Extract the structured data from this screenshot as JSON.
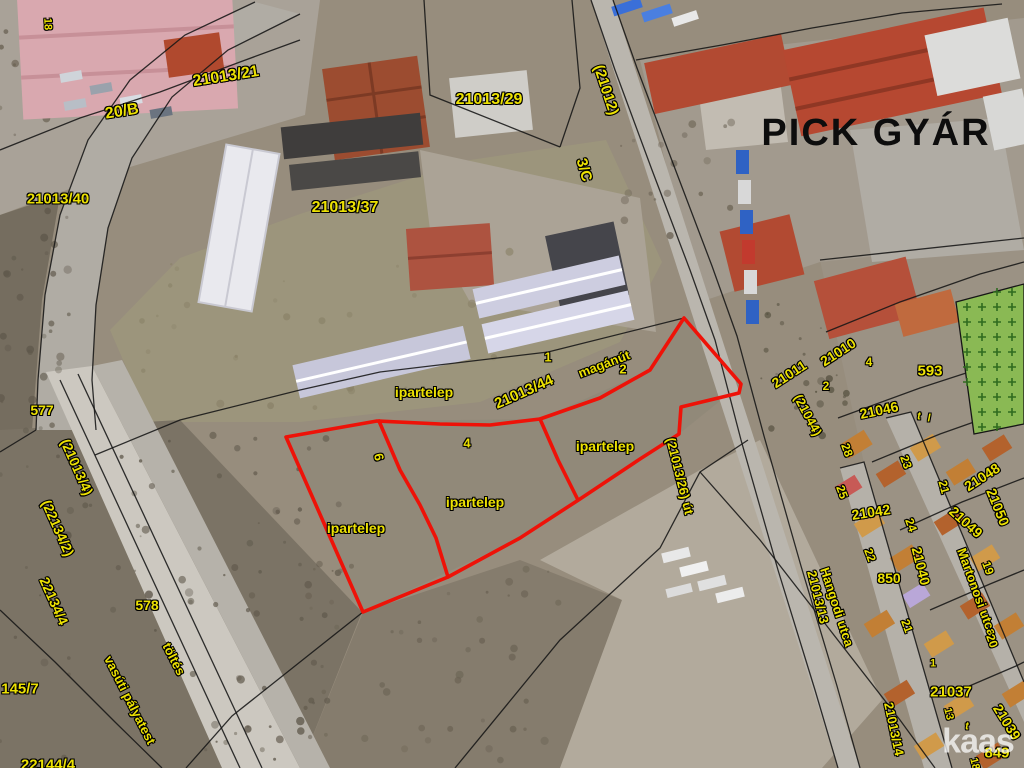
{
  "map": {
    "factory_name": "PICK GYÁR",
    "watermark": {
      "t": "kaas",
      "x": 978,
      "y": 742
    },
    "colors": {
      "label_yellow": "#ece103",
      "red_outline": "#ee1208",
      "boundary_black": "#161616",
      "green_field": "#8ab954",
      "green_cross": "#2f6b1f"
    },
    "labels": [
      {
        "t": "18",
        "x": 47,
        "y": 24,
        "r": 88,
        "s": 11
      },
      {
        "t": "21013/21",
        "x": 226,
        "y": 77,
        "r": -9,
        "s": 16
      },
      {
        "t": "20/B",
        "x": 122,
        "y": 112,
        "r": -9,
        "s": 16
      },
      {
        "t": "21013/40",
        "x": 58,
        "y": 199,
        "r": 0,
        "s": 15
      },
      {
        "t": "21013/29",
        "x": 489,
        "y": 100,
        "r": 0,
        "s": 16
      },
      {
        "t": "(21012)",
        "x": 606,
        "y": 90,
        "r": 72,
        "s": 15
      },
      {
        "t": "3/C",
        "x": 584,
        "y": 170,
        "r": 74,
        "s": 15
      },
      {
        "t": "21013/37",
        "x": 345,
        "y": 208,
        "r": 0,
        "s": 16
      },
      {
        "t": "PICK GYÁR",
        "x": 876,
        "y": 133,
        "r": 0,
        "s": 38,
        "c": "k"
      },
      {
        "t": "577",
        "x": 42,
        "y": 410,
        "r": 0,
        "s": 14
      },
      {
        "t": "(21013/4)",
        "x": 77,
        "y": 467,
        "r": 66,
        "s": 14
      },
      {
        "t": "(22134/2)",
        "x": 58,
        "y": 528,
        "r": 66,
        "s": 14
      },
      {
        "t": "22134/4",
        "x": 54,
        "y": 601,
        "r": 66,
        "s": 14
      },
      {
        "t": "578",
        "x": 147,
        "y": 605,
        "r": 0,
        "s": 14
      },
      {
        "t": "töltés",
        "x": 174,
        "y": 659,
        "r": 63,
        "s": 13
      },
      {
        "t": "vasúti pályatest",
        "x": 130,
        "y": 700,
        "r": 63,
        "s": 13
      },
      {
        "t": "145/7",
        "x": 20,
        "y": 689,
        "r": 0,
        "s": 15
      },
      {
        "t": "22144/4",
        "x": 48,
        "y": 765,
        "r": 0,
        "s": 15
      },
      {
        "t": "ipartelep",
        "x": 424,
        "y": 392,
        "r": 0,
        "s": 14
      },
      {
        "t": "1",
        "x": 548,
        "y": 357,
        "r": 0,
        "s": 13
      },
      {
        "t": "21013/44",
        "x": 524,
        "y": 392,
        "r": -24,
        "s": 15
      },
      {
        "t": "magánút",
        "x": 604,
        "y": 364,
        "r": -21,
        "s": 13
      },
      {
        "t": "2",
        "x": 623,
        "y": 369,
        "r": 0,
        "s": 13
      },
      {
        "t": "4",
        "x": 467,
        "y": 443,
        "r": 0,
        "s": 13
      },
      {
        "t": "6",
        "x": 379,
        "y": 457,
        "r": 78,
        "s": 13
      },
      {
        "t": "ipartelep",
        "x": 605,
        "y": 446,
        "r": 0,
        "s": 14
      },
      {
        "t": "ipartelep",
        "x": 475,
        "y": 502,
        "r": 0,
        "s": 14
      },
      {
        "t": "ipartelep",
        "x": 356,
        "y": 528,
        "r": 0,
        "s": 14
      },
      {
        "t": "(21013/26) út",
        "x": 680,
        "y": 476,
        "r": 76,
        "s": 13
      },
      {
        "t": "21011",
        "x": 789,
        "y": 374,
        "r": -33,
        "s": 14
      },
      {
        "t": "21010",
        "x": 838,
        "y": 352,
        "r": -33,
        "s": 14
      },
      {
        "t": "4",
        "x": 869,
        "y": 362,
        "r": 0,
        "s": 12
      },
      {
        "t": "2",
        "x": 826,
        "y": 386,
        "r": 0,
        "s": 12
      },
      {
        "t": "593",
        "x": 930,
        "y": 371,
        "r": 0,
        "s": 15
      },
      {
        "t": "(21044)",
        "x": 808,
        "y": 415,
        "r": 62,
        "s": 13
      },
      {
        "t": "21046",
        "x": 879,
        "y": 410,
        "r": -12,
        "s": 14
      },
      {
        "t": "t",
        "x": 919,
        "y": 417,
        "r": 0,
        "s": 11,
        "c": "i"
      },
      {
        "t": "l",
        "x": 929,
        "y": 419,
        "r": 0,
        "s": 11,
        "c": "i"
      },
      {
        "t": "28",
        "x": 847,
        "y": 450,
        "r": 70,
        "s": 12
      },
      {
        "t": "23",
        "x": 906,
        "y": 462,
        "r": 70,
        "s": 12
      },
      {
        "t": "21",
        "x": 944,
        "y": 487,
        "r": 75,
        "s": 12
      },
      {
        "t": "21048",
        "x": 982,
        "y": 477,
        "r": -33,
        "s": 14
      },
      {
        "t": "25",
        "x": 842,
        "y": 492,
        "r": 70,
        "s": 12
      },
      {
        "t": "21042",
        "x": 871,
        "y": 512,
        "r": -9,
        "s": 14
      },
      {
        "t": "21050",
        "x": 998,
        "y": 507,
        "r": 68,
        "s": 14
      },
      {
        "t": "21049",
        "x": 966,
        "y": 522,
        "r": 42,
        "s": 14
      },
      {
        "t": "24",
        "x": 911,
        "y": 525,
        "r": 70,
        "s": 12
      },
      {
        "t": "22",
        "x": 870,
        "y": 555,
        "r": 70,
        "s": 12
      },
      {
        "t": "850",
        "x": 889,
        "y": 578,
        "r": 0,
        "s": 14
      },
      {
        "t": "19",
        "x": 988,
        "y": 568,
        "r": 70,
        "s": 12
      },
      {
        "t": "21040",
        "x": 921,
        "y": 566,
        "r": 76,
        "s": 14
      },
      {
        "t": "Martonosi utca",
        "x": 977,
        "y": 592,
        "r": 70,
        "s": 13
      },
      {
        "t": "21013/13",
        "x": 818,
        "y": 597,
        "r": 76,
        "s": 13
      },
      {
        "t": "Hangodi utca",
        "x": 837,
        "y": 607,
        "r": 72,
        "s": 13
      },
      {
        "t": "21",
        "x": 907,
        "y": 626,
        "r": 70,
        "s": 12
      },
      {
        "t": "20",
        "x": 992,
        "y": 641,
        "r": 70,
        "s": 12
      },
      {
        "t": "1",
        "x": 933,
        "y": 664,
        "r": 0,
        "s": 11
      },
      {
        "t": "21037",
        "x": 951,
        "y": 692,
        "r": 0,
        "s": 15
      },
      {
        "t": "13",
        "x": 948,
        "y": 714,
        "r": 76,
        "s": 11
      },
      {
        "t": "t",
        "x": 967,
        "y": 727,
        "r": 0,
        "s": 11,
        "c": "i"
      },
      {
        "t": "21039",
        "x": 1007,
        "y": 722,
        "r": 58,
        "s": 14
      },
      {
        "t": "21013/14",
        "x": 894,
        "y": 729,
        "r": 78,
        "s": 13
      },
      {
        "t": "849",
        "x": 997,
        "y": 753,
        "r": 0,
        "s": 15
      },
      {
        "t": "18",
        "x": 974,
        "y": 764,
        "r": 76,
        "s": 11
      }
    ],
    "red_parcels": {
      "outer": "684,318 741,384 739,393 681,407 679,434 640,459 580,499 520,538 448,577 363,612 286,437 377,421 440,424 490,425 540,419 600,398 650,370 684,318",
      "dividers": [
        "379,421 400,470 420,505 436,538 448,577",
        "540,419 558,460 578,500"
      ]
    },
    "boundaries": [
      "591,0 615,70 652,170 690,270 715,340 741,440 778,570 815,690 838,768",
      "613,0 637,68 674,166 712,266 737,336 764,436 801,566 837,686 860,768",
      "95,455 180,420 300,390 380,372 548,352 684,318",
      "255,2 185,35 130,80 88,140 60,215 45,295 38,380 36,430",
      "300,14 228,50 172,97 132,158 108,228 96,305 92,380 96,430",
      "424,0 430,95 560,147",
      "560,147 580,88 572,0",
      "636,60 722,45 812,28 902,13 1002,4",
      "455,768 560,640 660,548 700,472 748,440",
      "363,612 300,662 232,716 186,768",
      "0,610 55,662 115,722 162,768",
      "36,430 0,452",
      "826,332 900,302 980,274 1024,262",
      "838,418 920,388 1000,362 1024,354",
      "872,462 940,434 1008,410 1024,404",
      "900,530 962,502 1024,478",
      "930,610 990,584 1024,570",
      "960,690 1016,666 1024,662",
      "700,472 760,540 830,630 900,720 935,768",
      "0,150 80,118 160,92 240,62 300,40",
      "60,380 240,768",
      "78,374 262,768",
      "840,468 864,462 952,768",
      "886,418 911,412 1024,682",
      "820,260 1024,238"
    ],
    "green_field": {
      "points": "956,302 1024,284 1024,424 974,434"
    }
  }
}
